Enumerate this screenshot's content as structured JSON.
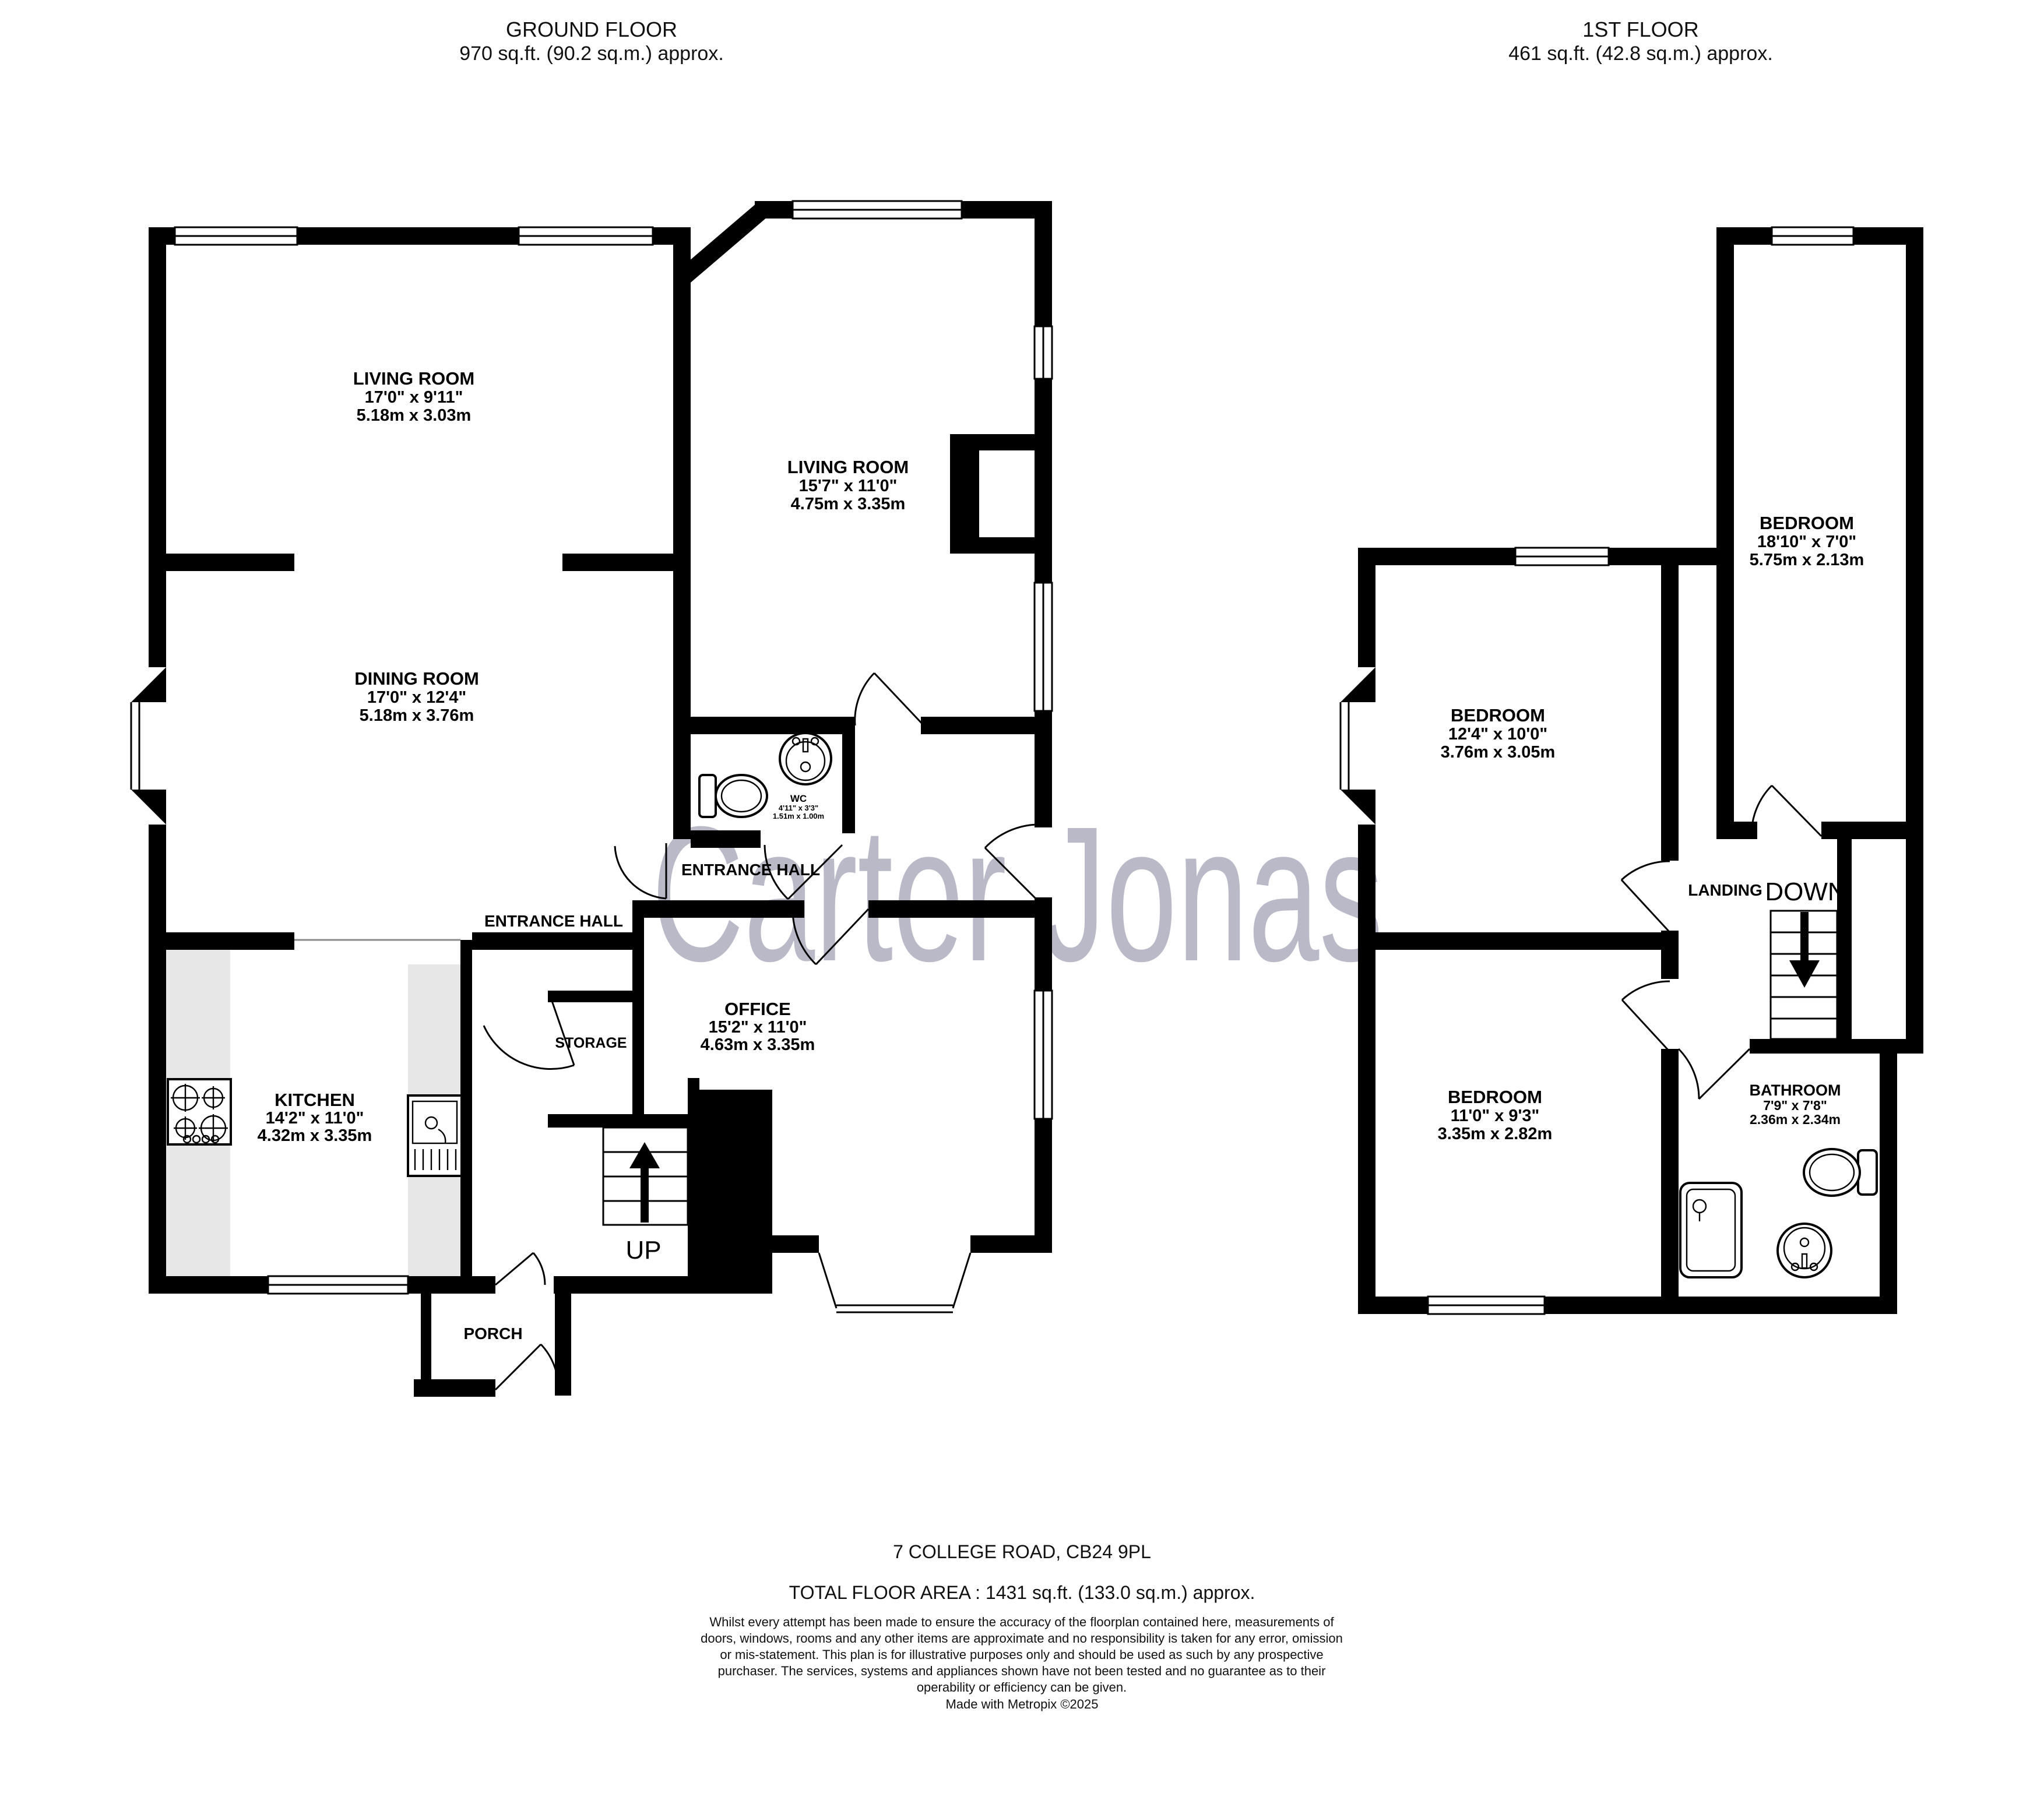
{
  "ground_floor": {
    "title": "GROUND FLOOR",
    "area": "970 sq.ft. (90.2 sq.m.) approx.",
    "rooms": {
      "living_room_left": {
        "name": "LIVING ROOM",
        "imperial": "17'0\"  x 9'11\"",
        "metric": "5.18m  x 3.03m"
      },
      "living_room_right": {
        "name": "LIVING ROOM",
        "imperial": "15'7\"  x 11'0\"",
        "metric": "4.75m  x 3.35m"
      },
      "dining_room": {
        "name": "DINING ROOM",
        "imperial": "17'0\"  x 12'4\"",
        "metric": "5.18m  x 3.76m"
      },
      "kitchen": {
        "name": "KITCHEN",
        "imperial": "14'2\"  x 11'0\"",
        "metric": "4.32m  x 3.35m"
      },
      "office": {
        "name": "OFFICE",
        "imperial": "15'2\"  x 11'0\"",
        "metric": "4.63m  x 3.35m"
      },
      "wc": {
        "name": "WC",
        "imperial": "4'11\"  x 3'3\"",
        "metric": "1.51m  x 1.00m"
      },
      "entrance_hall_left": {
        "name": "ENTRANCE HALL"
      },
      "entrance_hall_right": {
        "name": "ENTRANCE HALL"
      },
      "storage": {
        "name": "STORAGE"
      },
      "porch": {
        "name": "PORCH"
      },
      "stairs": {
        "label": "UP"
      }
    }
  },
  "first_floor": {
    "title": "1ST FLOOR",
    "area": "461 sq.ft. (42.8 sq.m.) approx.",
    "rooms": {
      "bedroom_right": {
        "name": "BEDROOM",
        "imperial": "18'10\"  x 7'0\"",
        "metric": "5.75m  x 2.13m"
      },
      "bedroom_middle": {
        "name": "BEDROOM",
        "imperial": "12'4\"  x 10'0\"",
        "metric": "3.76m  x 3.05m"
      },
      "bedroom_bottom": {
        "name": "BEDROOM",
        "imperial": "11'0\"  x 9'3\"",
        "metric": "3.35m  x 2.82m"
      },
      "bathroom": {
        "name": "BATHROOM",
        "imperial": "7'9\"  x 7'8\"",
        "metric": "2.36m  x 2.34m"
      },
      "landing": {
        "name": "LANDING"
      },
      "stairs": {
        "label": "DOWN"
      }
    }
  },
  "watermark": {
    "text": "Carter Jonas",
    "color": "#b9b9c8"
  },
  "footer": {
    "address": "7 COLLEGE ROAD, CB24 9PL",
    "total_area": "TOTAL FLOOR AREA : 1431 sq.ft. (133.0 sq.m.) approx.",
    "disclaimer": "Whilst every attempt has been made to ensure the accuracy of the floorplan contained here, measurements of doors, windows, rooms and any other items are approximate and no responsibility is taken for any error, omission or mis-statement. This plan is for illustrative purposes only and should be used as such by any prospective purchaser. The services, systems and appliances shown have not been tested and no guarantee as to their operability or efficiency can be given.",
    "credit": "Made with Metropix ©2025"
  }
}
